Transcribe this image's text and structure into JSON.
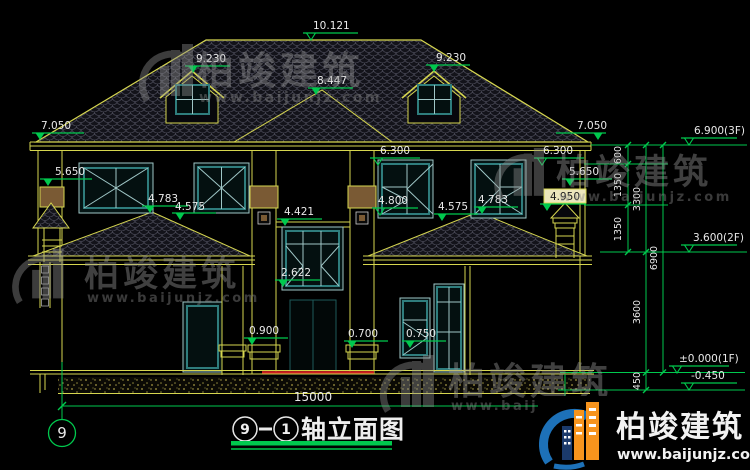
{
  "title_block": {
    "bubble_left": "9",
    "separator": "-",
    "bubble_right": "1",
    "label": "轴立面图"
  },
  "axis": {
    "bubble": "9"
  },
  "elev": {
    "ridge": "10.121",
    "dormer_left": "9.230",
    "dormer_right": "9.230",
    "front_hip": "8.447",
    "eave_left": "7.050",
    "eave_right": "7.050",
    "head_center": "6.300",
    "head_right": "6.300",
    "chimney_left": "5.650",
    "chimney_right": "5.650",
    "sill_band": "4.950",
    "porch_ridge_left": "4.783",
    "porch_hip_left": "4.575",
    "sill_right": "4.800",
    "porch_hip_right": "4.575",
    "porch_ridge_right": "4.783",
    "bay_head": "4.421",
    "bay_sill": "2.622",
    "plinth": "0.900",
    "porch_floor": "0.700",
    "porch_floor_right": "0.750",
    "floor3": "6.900(3F)",
    "floor2": "3.600(2F)",
    "floor1": "±0.000(1F)",
    "grade": "-0.450"
  },
  "dims": {
    "overall": "15000",
    "d600": "600",
    "d1350_up": "1350",
    "d1350_low": "1350",
    "d3300": "3300",
    "d3600": "3600",
    "d450": "450",
    "d6900": "6900"
  },
  "watermark": {
    "brand": "柏竣建筑",
    "url": "www.baijunjz.com"
  },
  "brand_banner": {
    "brand": "柏竣建筑",
    "url": "www.baijunjz.com"
  },
  "colors": {
    "line_yellow": "#d6d64f",
    "dim_green": "#00c94e",
    "frame_teal": "#3f9d9d",
    "accent_red": "#cc2020",
    "cap_brown": "#7a5a34",
    "brand_orange": "#f7941d",
    "brand_blue": "#1d71b8"
  }
}
